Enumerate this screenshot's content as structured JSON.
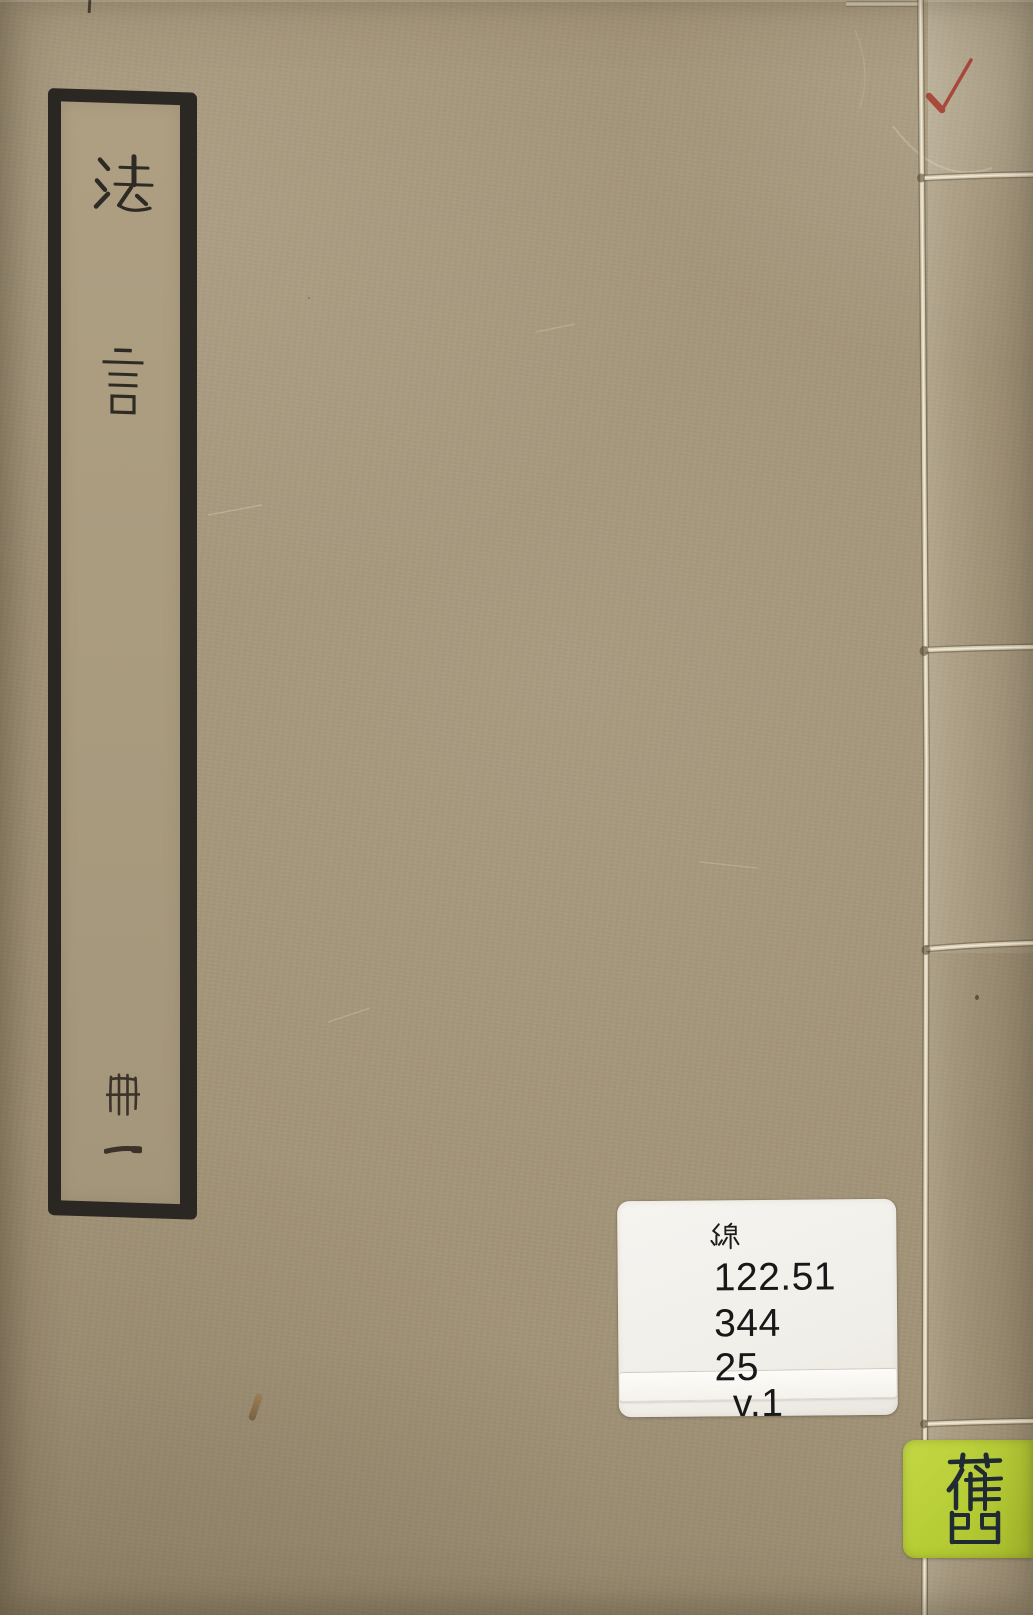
{
  "cover": {
    "background_color": "#a39478",
    "title_slip": {
      "title": "法言",
      "char_1": "法",
      "char_2": "言",
      "volume": "冊一",
      "volume_char_1": "冊",
      "volume_char_2": "一",
      "border_color": "#2b2823"
    },
    "red_checkmark": {
      "symbol": "✓",
      "color": "#a63c2f"
    },
    "library_label": {
      "script_char": "線",
      "call_number_line_1": "122.51",
      "call_number_line_2": "344",
      "call_number_line_3": "25",
      "volume_line": "v.1",
      "background_color": "#f3f1ec",
      "text_color": "#181818"
    },
    "condition_tag": {
      "character": "舊",
      "background_color": "#b7cd37",
      "ink_color": "#202b33"
    },
    "binding": {
      "thread_color": "#d9cfb8"
    }
  }
}
